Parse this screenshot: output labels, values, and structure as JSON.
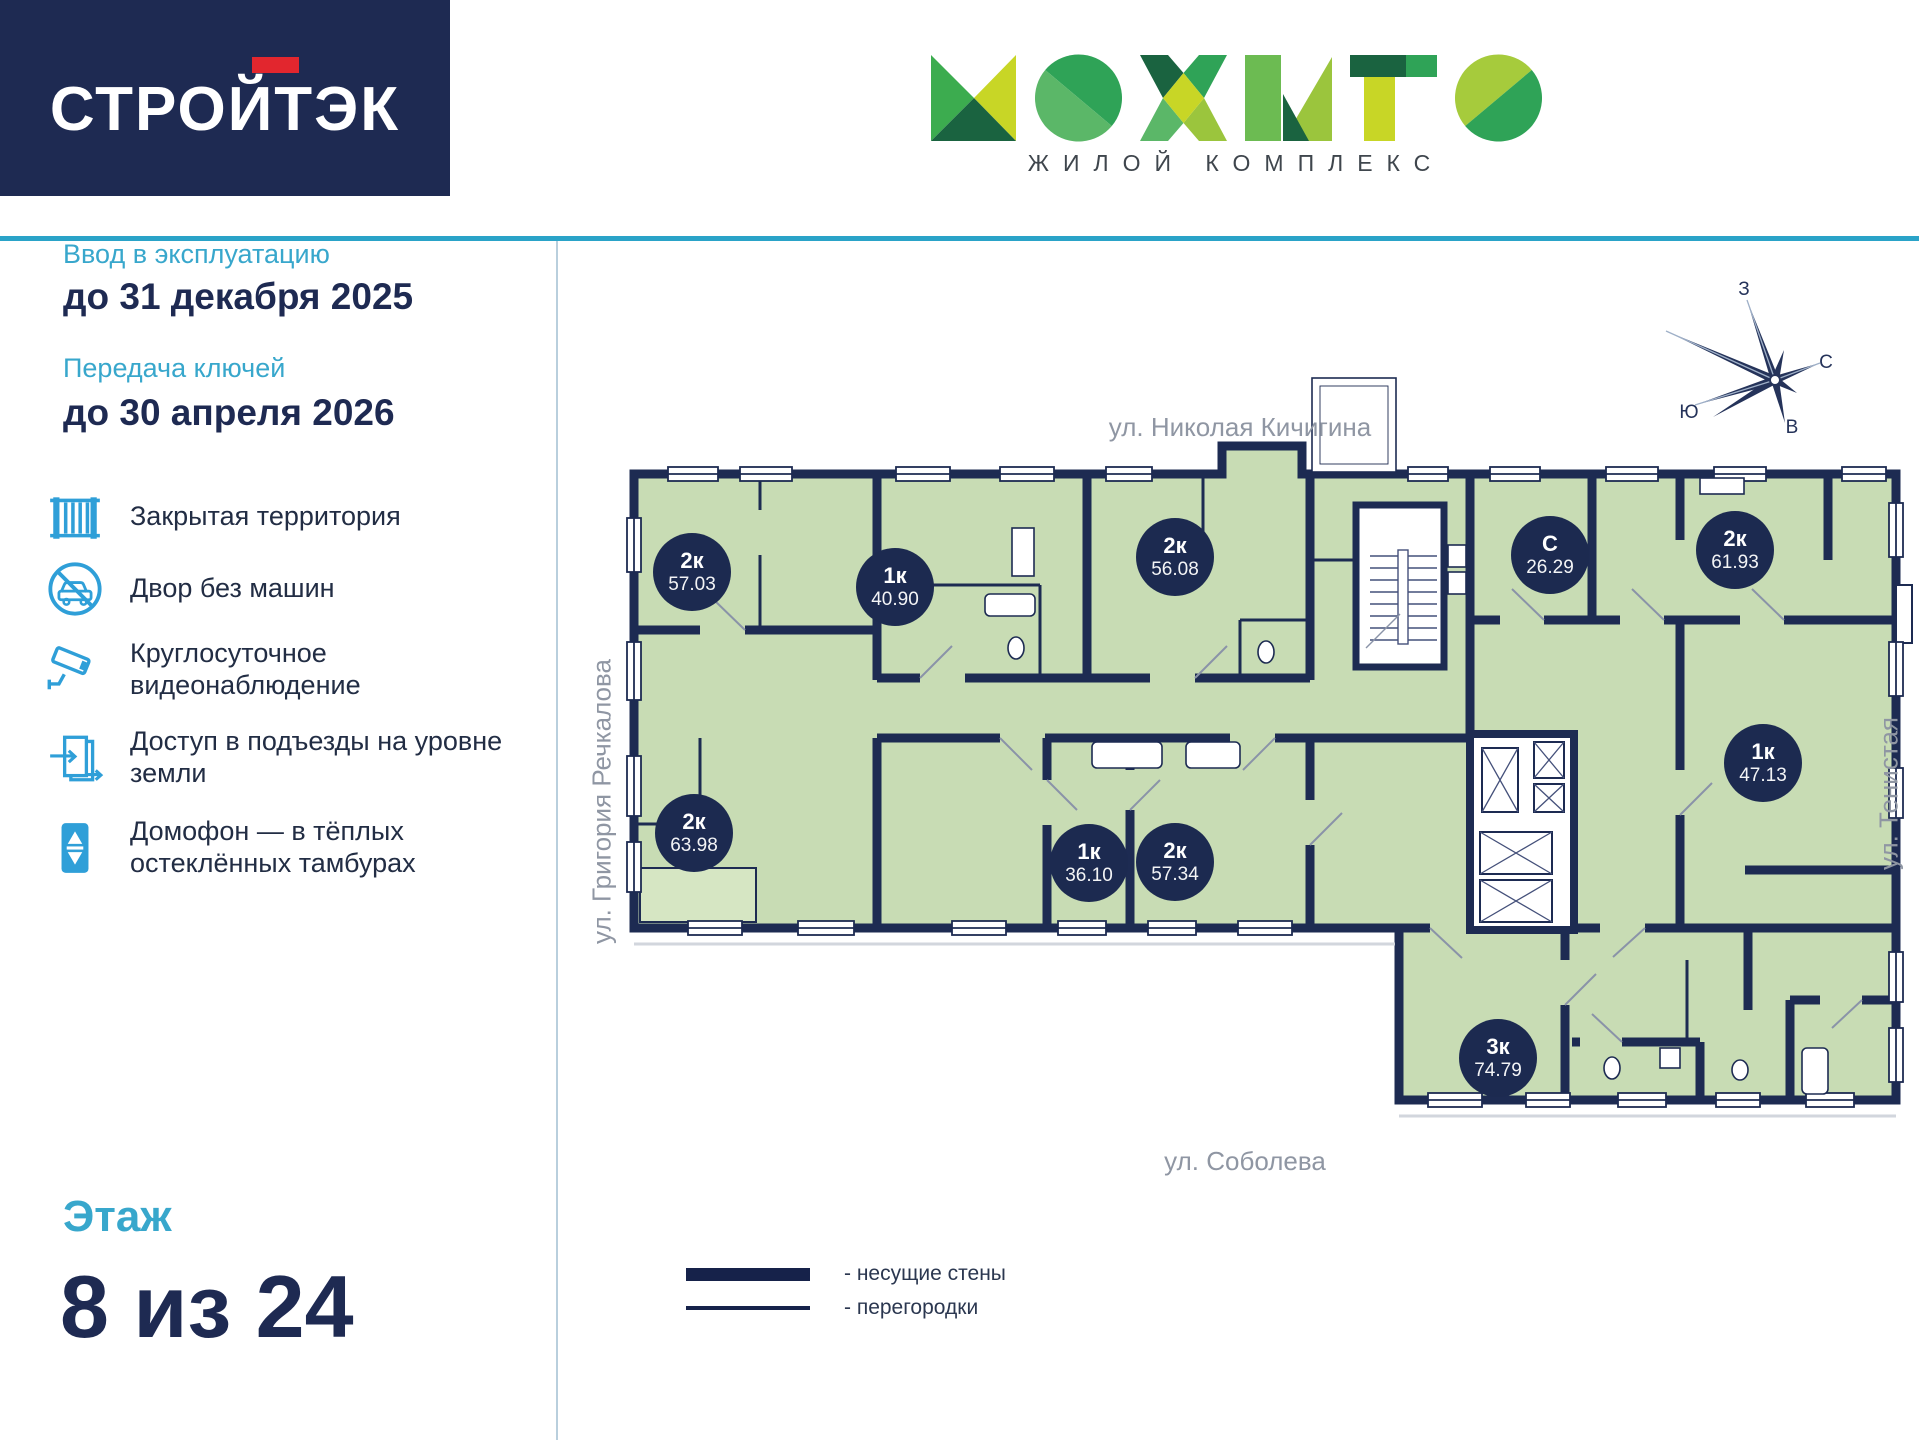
{
  "header": {
    "developer": "СТРОЙТЭК",
    "complex_name": "МОХИТО",
    "complex_type": "ЖИЛОЙ КОМПЛЕКС"
  },
  "sidebar": {
    "commissioning": {
      "label": "Ввод в эксплуатацию",
      "value": "до 31 декабря 2025"
    },
    "keys": {
      "label": "Передача ключей",
      "value": "до 30 апреля 2026"
    },
    "amenities": [
      {
        "icon": "fence-icon",
        "label": "Закрытая территория"
      },
      {
        "icon": "no-car-icon",
        "label": "Двор без машин"
      },
      {
        "icon": "cctv-icon",
        "label": "Круглосуточное видеонаблюдение"
      },
      {
        "icon": "door-access-icon",
        "label": "Доступ в подъезды на уровне земли"
      },
      {
        "icon": "intercom-icon",
        "label": "Домофон — в тёплых остеклённых тамбурах"
      }
    ],
    "floor": {
      "label": "Этаж",
      "value": "8 из 24"
    }
  },
  "plan": {
    "streets": {
      "top": "ул. Николая Кичигина",
      "left": "ул. Григория Речкалова",
      "right": "ул. Тенистая",
      "bottom": "ул. Соболева"
    },
    "compass": {
      "west": "З",
      "north": "С",
      "south": "Ю",
      "east": "В"
    },
    "apartments": [
      {
        "type": "2к",
        "area": "57.03"
      },
      {
        "type": "1к",
        "area": "40.90"
      },
      {
        "type": "2к",
        "area": "56.08"
      },
      {
        "type": "С",
        "area": "26.29"
      },
      {
        "type": "2к",
        "area": "61.93"
      },
      {
        "type": "1к",
        "area": "47.13"
      },
      {
        "type": "2к",
        "area": "63.98"
      },
      {
        "type": "1к",
        "area": "36.10"
      },
      {
        "type": "2к",
        "area": "57.34"
      },
      {
        "type": "3к",
        "area": "74.79"
      }
    ],
    "legend": [
      {
        "style": "thick",
        "label": "- несущие стены"
      },
      {
        "style": "thin",
        "label": "- перегородки"
      }
    ]
  },
  "colors": {
    "navy": "#1d2b52",
    "accent_blue": "#38a7cc",
    "icon_blue": "#2f9fd8",
    "room_green": "#c8dcb4",
    "logo_red": "#e2262e",
    "street_gray": "#8f96a3"
  }
}
